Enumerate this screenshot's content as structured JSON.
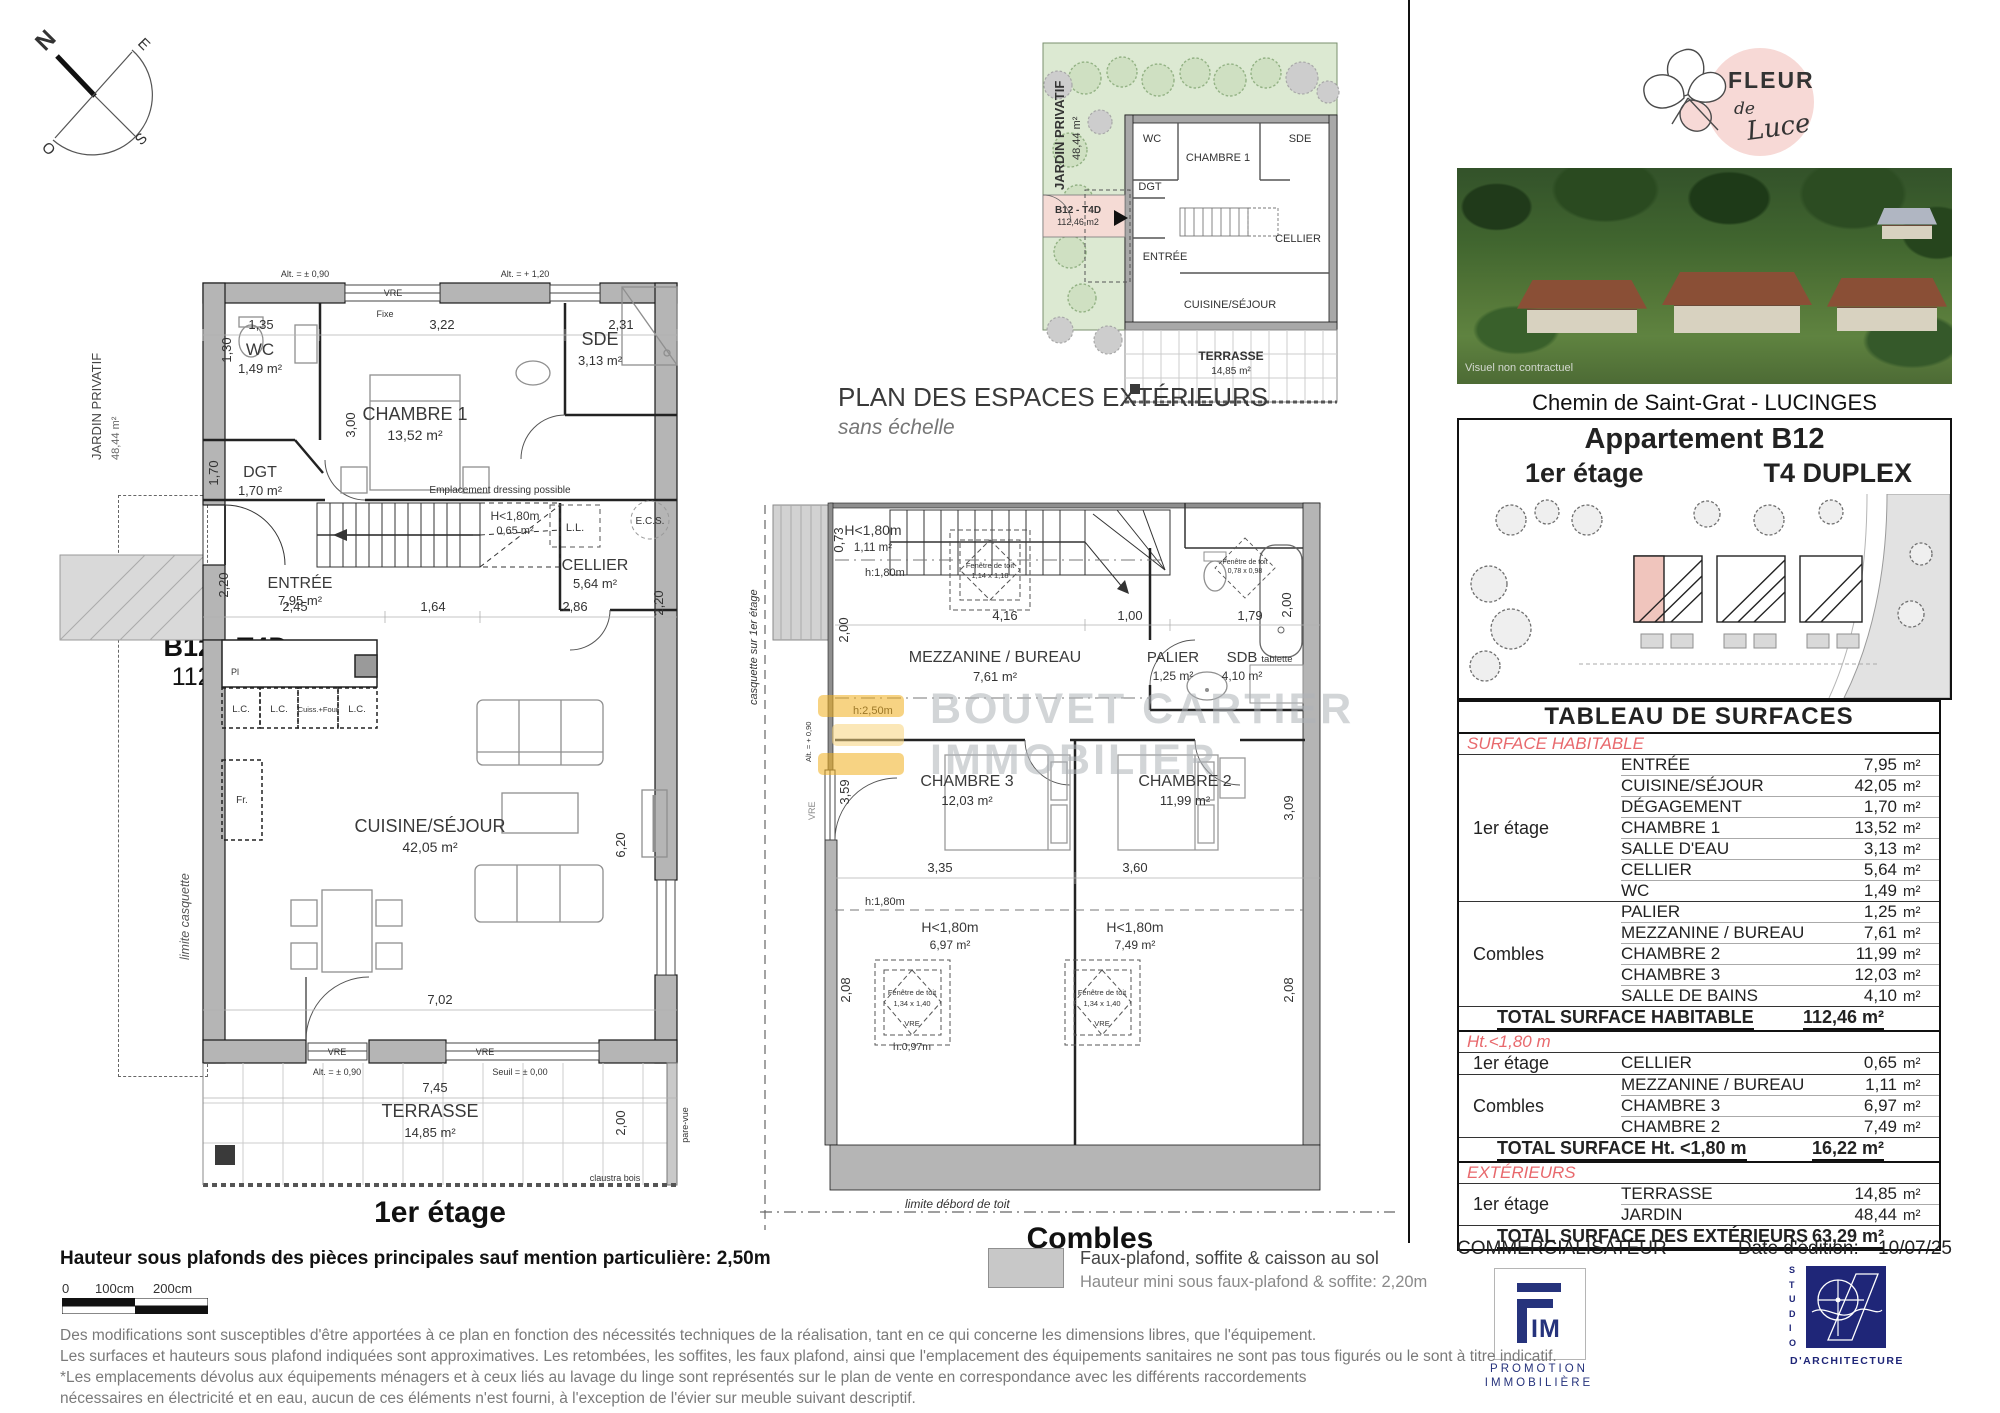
{
  "compass": {
    "n": "N",
    "e": "E",
    "s": "S",
    "o": "O"
  },
  "side": {
    "jardin": "JARDIN PRIVATIF",
    "jardin_area": "48,44 m²",
    "b12": "B12 - T4D",
    "b12_area": "112,46 m2",
    "limite_casquette": "limite casquette"
  },
  "plan1": {
    "caption": "1er étage",
    "wc": {
      "name": "WC",
      "area": "1,49 m²"
    },
    "dgt": {
      "name": "DGT",
      "area": "1,70 m²"
    },
    "chambre1": {
      "name": "CHAMBRE 1",
      "area": "13,52 m²"
    },
    "sde": {
      "name": "SDE",
      "area": "3,13 m²"
    },
    "h180": {
      "name": "H<1,80m",
      "area": "0,65 m²"
    },
    "cellier": {
      "name": "CELLIER",
      "area": "5,64 m²"
    },
    "entree": {
      "name": "ENTRÉE",
      "area": "7,95 m²"
    },
    "cuisine": {
      "name": "CUISINE/SÉJOUR",
      "area": "42,05 m²"
    },
    "terrasse": {
      "name": "TERRASSE",
      "area": "14,85 m²"
    },
    "labels": {
      "vre": "VRE",
      "fixe": "Fixe",
      "ll": "L.L.",
      "ecs": "E.C.S.",
      "dressing": "Emplacement dressing possible",
      "lc": "L.C.",
      "cuiss": "Cuiss.+Four",
      "pl": "Pl",
      "fr": "Fr.",
      "alt090": "Alt. = ± 0,90",
      "alt120": "Alt. = + 1,20",
      "seuil": "Seuil = ± 0,00",
      "claustra": "claustra bois",
      "parevue": "pare-vue"
    },
    "dims": {
      "d135": "1,35",
      "d322": "3,22",
      "d231": "2,31",
      "d300": "3,00",
      "d130": "1,30",
      "d170": "1,70",
      "d220": "2,20",
      "d245": "2,45",
      "d164": "1,64",
      "d286": "2,86",
      "d702": "7,02",
      "d620": "6,20",
      "d745": "7,45",
      "d200": "2,00"
    }
  },
  "plan_ext": {
    "title": "PLAN DES ESPACES EXTÉRIEURS",
    "subtitle": "sans échelle",
    "jardin": "JARDIN PRIVATIF",
    "jardin_area": "48,44 m²",
    "b12": "B12 - T4D",
    "b12_area": "112,46 m2",
    "wc": "WC",
    "chambre1": "CHAMBRE 1",
    "sde": "SDE",
    "dgt": "DGT",
    "entree": "ENTRÉE",
    "cellier": "CELLIER",
    "cuisine": "CUISINE/SÉJOUR",
    "terrasse": "TERRASSE",
    "terrasse_area": "14,85 m²"
  },
  "plan2": {
    "caption": "Combles",
    "h180_top": {
      "name": "H<1,80m",
      "area": "1,11 m²"
    },
    "mezzanine": {
      "name": "MEZZANINE / BUREAU",
      "area": "7,61 m²"
    },
    "palier": {
      "name": "PALIER",
      "area": "1,25 m²"
    },
    "sdb": {
      "name": "SDB",
      "area": "4,10 m²"
    },
    "chambre3": {
      "name": "CHAMBRE 3",
      "area": "12,03 m²"
    },
    "chambre2": {
      "name": "CHAMBRE 2",
      "area": "11,99 m²"
    },
    "h180_c3": {
      "name": "H<1,80m",
      "area": "6,97 m²"
    },
    "h180_c2": {
      "name": "H<1,80m",
      "area": "7,49 m²"
    },
    "labels": {
      "h180": "h:1,80m",
      "h250": "h:2,50m",
      "h097": "h:0,97m",
      "tablette": "tablette",
      "fdt": "Fenêtre de toit",
      "fdt1_size": "1,14 x 1,18",
      "fdt2_size": "0,78 x 0,98",
      "fdt3_size": "1,34 x 1,40",
      "vre": "VRE",
      "casquette": "casquette sur 1er étage",
      "limite_debord": "limite débord de toit",
      "alt": "Alt. = + 0,90"
    },
    "dims": {
      "d073": "0,73",
      "d200l": "2,00",
      "d416": "4,16",
      "d100": "1,00",
      "d179": "1,79",
      "d200r": "2,00",
      "d359": "3,59",
      "d309": "3,09",
      "d335": "3,35",
      "d360": "3,60",
      "d208l": "2,08",
      "d208r": "2,08"
    }
  },
  "watermark": {
    "line1": "BOUVET CARTIER",
    "line2": "IMMOBILIER"
  },
  "brand": {
    "fleur": "FLEUR",
    "de": "de",
    "luce": "Luce"
  },
  "photo": {
    "caption": "Visuel non contractuel"
  },
  "project": {
    "address": "Chemin de Saint-Grat - LUCINGES",
    "apartment": "Appartement B12",
    "floor": "1er étage",
    "type": "T4 DUPLEX"
  },
  "table": {
    "title": "TABLEAU DE SURFACES",
    "s1": {
      "heading": "SURFACE HABITABLE",
      "g1": {
        "label": "1er étage",
        "rows": [
          {
            "name": "ENTRÉE",
            "v": "7,95",
            "u": "m²"
          },
          {
            "name": "CUISINE/SÉJOUR",
            "v": "42,05",
            "u": "m²"
          },
          {
            "name": "DÉGAGEMENT",
            "v": "1,70",
            "u": "m²"
          },
          {
            "name": "CHAMBRE 1",
            "v": "13,52",
            "u": "m²"
          },
          {
            "name": "SALLE D'EAU",
            "v": "3,13",
            "u": "m²"
          },
          {
            "name": "CELLIER",
            "v": "5,64",
            "u": "m²"
          },
          {
            "name": "WC",
            "v": "1,49",
            "u": "m²"
          }
        ]
      },
      "g2": {
        "label": "Combles",
        "rows": [
          {
            "name": "PALIER",
            "v": "1,25",
            "u": "m²"
          },
          {
            "name": "MEZZANINE / BUREAU",
            "v": "7,61",
            "u": "m²"
          },
          {
            "name": "CHAMBRE 2",
            "v": "11,99",
            "u": "m²"
          },
          {
            "name": "CHAMBRE 3",
            "v": "12,03",
            "u": "m²"
          },
          {
            "name": "SALLE DE BAINS",
            "v": "4,10",
            "u": "m²"
          }
        ]
      },
      "total": {
        "label": "TOTAL SURFACE HABITABLE",
        "value": "112,46 m²"
      }
    },
    "s2": {
      "heading": "Ht.<1,80 m",
      "g1": {
        "label": "1er étage",
        "rows": [
          {
            "name": "CELLIER",
            "v": "0,65",
            "u": "m²"
          }
        ]
      },
      "g2": {
        "label": "Combles",
        "rows": [
          {
            "name": "MEZZANINE / BUREAU",
            "v": "1,11",
            "u": "m²"
          },
          {
            "name": "CHAMBRE 3",
            "v": "6,97",
            "u": "m²"
          },
          {
            "name": "CHAMBRE 2",
            "v": "7,49",
            "u": "m²"
          }
        ]
      },
      "total": {
        "label": "TOTAL SURFACE Ht. <1,80 m",
        "value": "16,22 m²"
      }
    },
    "s3": {
      "heading": "EXTÉRIEURS",
      "g1": {
        "label": "1er étage",
        "rows": [
          {
            "name": "TERRASSE",
            "v": "14,85",
            "u": "m²"
          },
          {
            "name": "JARDIN",
            "v": "48,44",
            "u": "m²"
          }
        ]
      },
      "total": {
        "label": "TOTAL SURFACE  DES EXTÉRIEURS",
        "value": "63,29 m²"
      }
    }
  },
  "commercial": {
    "label": "COMMERCIALISATEUR",
    "date_label": "Date d'édition:",
    "date": "10/07/25",
    "fim_im": "IM",
    "fim_sub1": "PROMOTION",
    "fim_sub2": "IMMOBILIÈRE",
    "studio_side": "STUDIO",
    "studio_label": "D'ARCHITECTURE"
  },
  "footer": {
    "height_note": "Hauteur sous plafonds des pièces principales sauf mention particulière: 2,50m",
    "scale0": "0",
    "scale100": "100cm",
    "scale200": "200cm",
    "legend1": "Faux-plafond, soffite & caisson au sol",
    "legend2": "Hauteur mini sous faux-plafond & soffite: 2,20m",
    "disclaimer": [
      "Des modifications sont susceptibles d'être apportées à ce plan en fonction des nécessités techniques de la réalisation, tant en ce qui concerne les dimensions libres, que l'équipement.",
      "Les surfaces et hauteurs sous plafond indiquées sont approximatives. Les retombées, les soffites, les faux plafond, ainsi que l'emplacement des équipements sanitaires ne sont pas tous figurés ou le sont à titre indicatif.",
      "*Les emplacements dévolus aux équipements ménagers et à ceux liés au lavage du linge sont représentés sur le plan de vente en correspondance avec les différents raccordements",
      "nécessaires en électricité et en eau, aucun de ces éléments n'est fourni, à l'exception de l'évier sur meuble suivant descriptif."
    ]
  }
}
